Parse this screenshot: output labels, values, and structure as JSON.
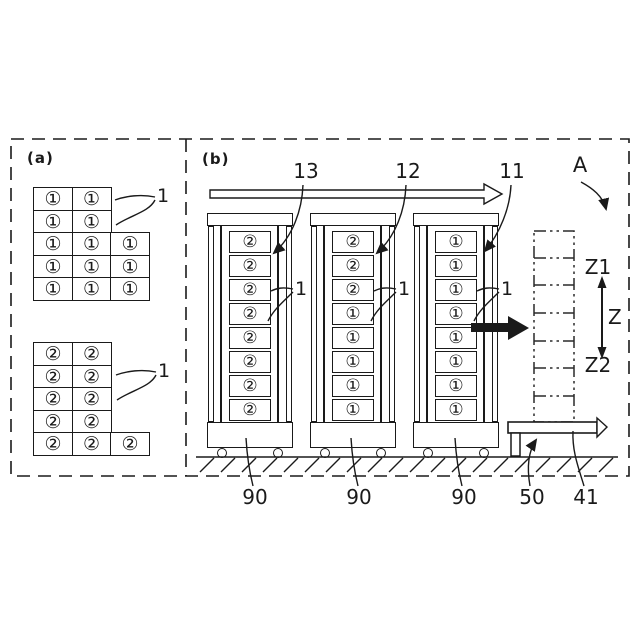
{
  "colors": {
    "ink": "#1a1a1a",
    "background": "#ffffff"
  },
  "panel_a": {
    "label": "(a)",
    "grid1": {
      "ref": "1",
      "rows": [
        [
          "①",
          "①"
        ],
        [
          "①",
          "①"
        ],
        [
          "①",
          "①",
          "①"
        ],
        [
          "①",
          "①",
          "①"
        ],
        [
          "①",
          "①",
          "①"
        ]
      ]
    },
    "grid2": {
      "ref": "1",
      "rows": [
        [
          "②",
          "②"
        ],
        [
          "②",
          "②"
        ],
        [
          "②",
          "②"
        ],
        [
          "②",
          "②"
        ],
        [
          "②",
          "②",
          "②"
        ]
      ]
    }
  },
  "panel_b": {
    "label": "(b)",
    "towers": [
      {
        "top_ref": "13",
        "side_ref": "1",
        "base_ref": "90",
        "cells": [
          "②",
          "②",
          "②",
          "②",
          "②",
          "②",
          "②",
          "②"
        ]
      },
      {
        "top_ref": "12",
        "side_ref": "1",
        "base_ref": "90",
        "cells": [
          "②",
          "②",
          "②",
          "①",
          "①",
          "①",
          "①",
          "①"
        ]
      },
      {
        "top_ref": "11",
        "side_ref": "1",
        "base_ref": "90",
        "cells": [
          "①",
          "①",
          "①",
          "①",
          "①",
          "①",
          "①",
          "①"
        ]
      }
    ],
    "view_ref": "A",
    "z_axis": {
      "top": "Z1",
      "mid": "Z",
      "bottom": "Z2"
    },
    "stand_ref": "50",
    "conveyor_ref": "41"
  }
}
